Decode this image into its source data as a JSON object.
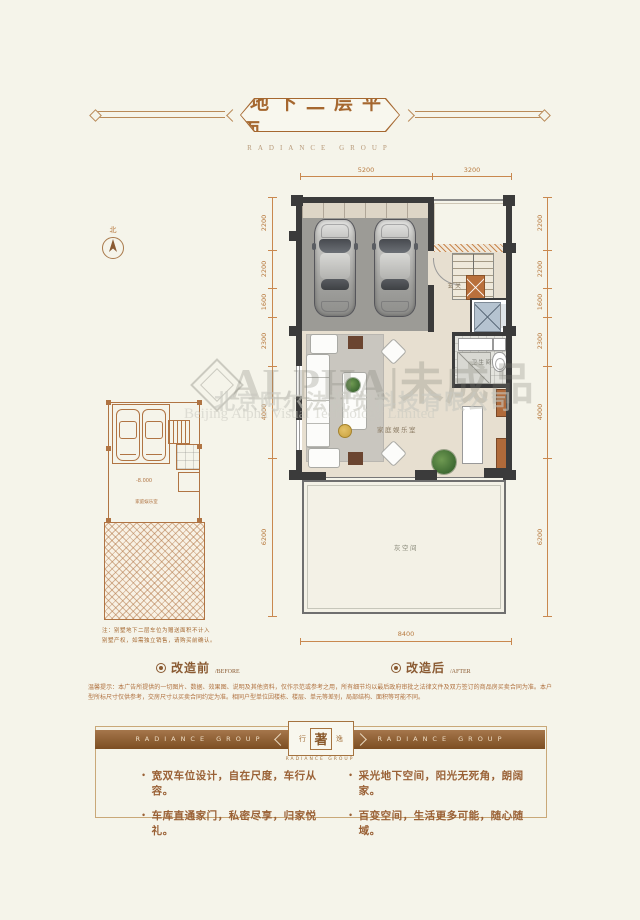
{
  "header": {
    "title": "地下二层平面",
    "subtitle": "RADIANCE GROUP"
  },
  "compass": {
    "north": "北"
  },
  "plan": {
    "labels": {
      "entry": "玄关",
      "bath": "卫生间",
      "family": "家庭娱乐室",
      "gray": "灰空间"
    },
    "dims": {
      "top": [
        "5200",
        "3200"
      ],
      "right": [
        "2200",
        "2200",
        "1600",
        "2300",
        "4000",
        "6200"
      ],
      "left": [
        "2200",
        "2200",
        "1600",
        "2300",
        "4000",
        "6200"
      ],
      "bottom": "8400"
    }
  },
  "small_plan": {
    "elevation": "-8.000",
    "room": "家庭娱乐室"
  },
  "note": {
    "line1": "注：别墅地下二层车位为赠送面积不计入",
    "line2": "别墅产权，如需独立销售，请购买前确认。"
  },
  "legend": {
    "before_cn": "改造前",
    "before_en": "/BEFORE",
    "after_cn": "改造后",
    "after_en": "/AFTER"
  },
  "disclaimer": "温馨提示：本广告所提供的一切图片、数据、效果图、说明及其他资料，仅作示范或参考之用，所有细节均以最后政府审批之法律文件及双方签订的商品房买卖合同为准。本户型所标尺寸仅供参考，交房尺寸以买卖合同约定为准。相同户型单位因楼栋、楼层、单元等差别，局部结构、面积等可能不同。",
  "footer": {
    "band_left": "RADIANCE GROUP",
    "band_right": "RADIANCE GROUP",
    "medallion": {
      "left": "行",
      "center": "著",
      "right": "逸",
      "caption": "RADIANCE GROUP"
    },
    "bullets": [
      "宽双车位设计，自在尺度，车行从容。",
      "车库直通家门，私密尽享，归家悦礼。",
      "采光地下空间，阳光无死角，朗阔家。",
      "百变空间，生活更多可能，随心随域。"
    ]
  },
  "watermark": {
    "big": "ALPHA|未成品",
    "company_cn": "北京阿尔法视觉科技有限公司",
    "company_en": "Beijing Alpha Visual Technology Limited"
  },
  "colors": {
    "accent": "#a5672f",
    "dim_line": "#c9884f",
    "wall": "#3b3b3b",
    "band": "#8a5a2e"
  }
}
